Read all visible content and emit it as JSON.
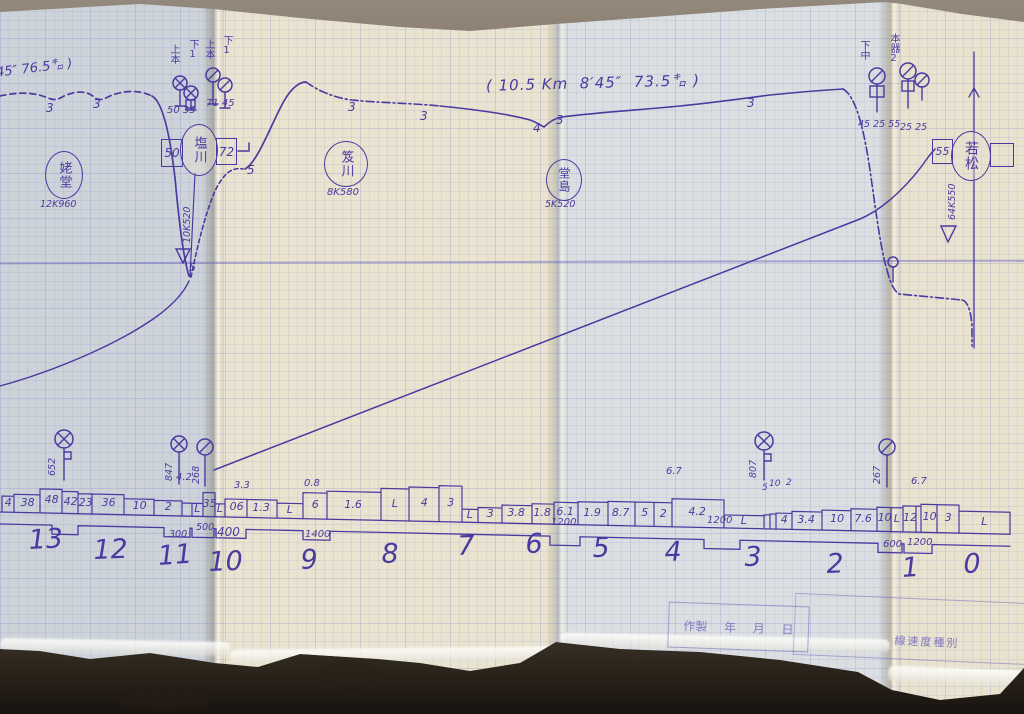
{
  "ink_color": "#4a3aa0",
  "annotations": {
    "main": "( 10.5 Km  8′45″  73.5㌔ )",
    "left_partial": "45″ 76.5㌔ )"
  },
  "stations": {
    "ubado": {
      "name": "姥堂",
      "km": "12K960"
    },
    "shiokawa": {
      "name": "塩川",
      "km": "10K520",
      "left_box": "50",
      "right_box": "72"
    },
    "oikawa": {
      "name": "笈川",
      "km": "8K580"
    },
    "dojima": {
      "name": "堂島",
      "km": "5K520"
    },
    "wakamatsu": {
      "name": "若松",
      "km": "64K550",
      "left_box": "55",
      "right_box": ""
    }
  },
  "stamp": {
    "made": "作製",
    "year": "年",
    "month": "月",
    "day": "日",
    "speed_class": "線速度種別"
  },
  "chart_data": {
    "type": "line",
    "title": "手書き運転曲線図（会津若松方面）",
    "run_annotation": {
      "distance_km": 10.5,
      "time": "8'45\"",
      "speed": "73.5 km/h"
    },
    "km_posts": [
      "13",
      "12",
      "11",
      "10",
      "9",
      "8",
      "7",
      "6",
      "5",
      "4",
      "3",
      "2",
      "1",
      "0"
    ],
    "speed_curve_marks": [
      "3",
      "3",
      "5",
      "3",
      "3",
      "4",
      "3",
      "3",
      "5"
    ],
    "gradient_profile_values": [
      "4",
      "38",
      "48",
      "42",
      "23",
      "36",
      "10",
      "2",
      "L",
      "35",
      "L",
      "06",
      "1.3",
      "L",
      "6",
      "1.6",
      "L",
      "4",
      "3",
      "L",
      "3",
      "3.8",
      "1.8",
      "6.1",
      "1.9",
      "8.7",
      "5",
      "2",
      "4.2",
      "L",
      "4",
      "3.4",
      "10",
      "7.6",
      "10",
      "L",
      "12",
      "10",
      "3",
      "L"
    ],
    "gradient_above_labels": [
      "4.2",
      "3.3",
      "0.8",
      "6.7",
      "5",
      "10",
      "2",
      "6.7"
    ],
    "curve_radius_restrictions": [
      "300",
      "500",
      "400",
      "1400",
      "1200",
      "1200",
      "600",
      "1200"
    ],
    "signal_numbers": [
      "50 35",
      "71 45",
      "45 25 55",
      "25 25",
      "652",
      "847",
      "268",
      "807",
      "267"
    ],
    "track_labels": [
      "上本",
      "下1",
      "上本",
      "下1",
      "下中",
      "本器2"
    ]
  },
  "texts": [
    {
      "t": "3",
      "x": 46,
      "y": 102,
      "s": 12
    },
    {
      "t": "3",
      "x": 93,
      "y": 98,
      "s": 12
    },
    {
      "t": "5",
      "x": 247,
      "y": 164,
      "s": 12
    },
    {
      "t": "3",
      "x": 348,
      "y": 101,
      "s": 12
    },
    {
      "t": "3",
      "x": 420,
      "y": 110,
      "s": 12
    },
    {
      "t": "4",
      "x": 533,
      "y": 122,
      "s": 12
    },
    {
      "t": "3",
      "x": 556,
      "y": 114,
      "s": 12
    },
    {
      "t": "3",
      "x": 747,
      "y": 97,
      "s": 12
    },
    {
      "t": "5",
      "x": 189,
      "y": 262,
      "s": 11
    },
    {
      "t": "50 35",
      "x": 167,
      "y": 106,
      "s": 10
    },
    {
      "t": "71 45",
      "x": 206,
      "y": 99,
      "s": 10
    },
    {
      "t": "45 25 55",
      "x": 858,
      "y": 120,
      "s": 9.5
    },
    {
      "t": "25 25",
      "x": 900,
      "y": 123,
      "s": 9.5
    },
    {
      "t": "上本",
      "x": 168,
      "y": 44,
      "s": 10,
      "v": 1
    },
    {
      "t": "下1",
      "x": 187,
      "y": 39,
      "s": 10,
      "v": 1
    },
    {
      "t": "上本",
      "x": 203,
      "y": 39,
      "s": 10,
      "v": 1
    },
    {
      "t": "下1",
      "x": 221,
      "y": 35,
      "s": 10,
      "v": 1
    },
    {
      "t": "下中",
      "x": 858,
      "y": 40,
      "s": 10,
      "v": 1
    },
    {
      "t": "本器2",
      "x": 888,
      "y": 33,
      "s": 10,
      "v": 1
    },
    {
      "t": "10K520",
      "x": 183,
      "y": 243,
      "s": 9.5,
      "r": -90
    },
    {
      "t": "64K550",
      "x": 948,
      "y": 220,
      "s": 9.5,
      "r": -90
    },
    {
      "t": "652",
      "x": 48,
      "y": 476,
      "s": 9.5,
      "r": -90
    },
    {
      "t": "847",
      "x": 165,
      "y": 481,
      "s": 9.5,
      "r": -90
    },
    {
      "t": "268",
      "x": 192,
      "y": 484,
      "s": 9.5,
      "r": -90
    },
    {
      "t": "807",
      "x": 749,
      "y": 478,
      "s": 9.5,
      "r": -90
    },
    {
      "t": "267",
      "x": 873,
      "y": 484,
      "s": 9.5,
      "r": -90
    },
    {
      "t": "4.2",
      "x": 176,
      "y": 473,
      "s": 10
    },
    {
      "t": "3.3",
      "x": 234,
      "y": 481,
      "s": 10
    },
    {
      "t": "0.8",
      "x": 304,
      "y": 479,
      "s": 10
    },
    {
      "t": "6.7",
      "x": 666,
      "y": 467,
      "s": 10
    },
    {
      "t": "5",
      "x": 762,
      "y": 484,
      "s": 9
    },
    {
      "t": "10",
      "x": 769,
      "y": 480,
      "s": 9
    },
    {
      "t": "2",
      "x": 786,
      "y": 479,
      "s": 9
    },
    {
      "t": "6.7",
      "x": 911,
      "y": 477,
      "s": 10
    },
    {
      "t": "300",
      "x": 169,
      "y": 530,
      "s": 9.5
    },
    {
      "t": "500",
      "x": 196,
      "y": 523,
      "s": 9.5
    },
    {
      "t": "400",
      "x": 217,
      "y": 526,
      "s": 12
    },
    {
      "t": "1400",
      "x": 305,
      "y": 530,
      "s": 10
    },
    {
      "t": "1200",
      "x": 551,
      "y": 518,
      "s": 10
    },
    {
      "t": "1200",
      "x": 707,
      "y": 516,
      "s": 10
    },
    {
      "t": "600",
      "x": 883,
      "y": 540,
      "s": 10
    },
    {
      "t": "1200",
      "x": 907,
      "y": 538,
      "s": 10
    },
    {
      "t": "13",
      "x": 28,
      "y": 527,
      "s": 27,
      "r": -3
    },
    {
      "t": "12",
      "x": 93,
      "y": 537,
      "s": 27,
      "r": -2
    },
    {
      "t": "11",
      "x": 157,
      "y": 543,
      "s": 27,
      "r": -4
    },
    {
      "t": "10",
      "x": 208,
      "y": 549,
      "s": 27,
      "r": -2
    },
    {
      "t": "9",
      "x": 300,
      "y": 547,
      "s": 27,
      "r": -3
    },
    {
      "t": "8",
      "x": 381,
      "y": 541,
      "s": 27,
      "r": -2
    },
    {
      "t": "7",
      "x": 457,
      "y": 533,
      "s": 27,
      "r": -2
    },
    {
      "t": "6",
      "x": 525,
      "y": 531,
      "s": 27,
      "r": -2
    },
    {
      "t": "5",
      "x": 592,
      "y": 535,
      "s": 27,
      "r": -2
    },
    {
      "t": "4",
      "x": 664,
      "y": 539,
      "s": 27,
      "r": -2
    },
    {
      "t": "3",
      "x": 744,
      "y": 544,
      "s": 27,
      "r": -2
    },
    {
      "t": "2",
      "x": 826,
      "y": 551,
      "s": 27,
      "r": -2
    },
    {
      "t": "1",
      "x": 901,
      "y": 555,
      "s": 27,
      "r": -4
    },
    {
      "t": "0",
      "x": 963,
      "y": 551,
      "s": 27,
      "r": -2
    }
  ],
  "profile_cells": [
    [
      2,
      12,
      "4",
      16
    ],
    [
      14,
      26,
      "38",
      18
    ],
    [
      40,
      22,
      "48",
      24
    ],
    [
      62,
      16,
      "42",
      22
    ],
    [
      78,
      14,
      "23",
      20
    ],
    [
      92,
      32,
      "36",
      20
    ],
    [
      124,
      30,
      "10",
      16
    ],
    [
      154,
      28,
      "2",
      15
    ],
    [
      182,
      10,
      "",
      13
    ],
    [
      192,
      11,
      "L",
      13
    ],
    [
      203,
      12,
      "35",
      24
    ],
    [
      215,
      10,
      "L",
      13
    ],
    [
      225,
      22,
      "06",
      18
    ],
    [
      247,
      30,
      "1.3",
      18
    ],
    [
      277,
      26,
      "L",
      15
    ],
    [
      303,
      24,
      "6",
      26
    ],
    [
      327,
      54,
      "1.6",
      28
    ],
    [
      381,
      28,
      "L",
      32
    ],
    [
      409,
      30,
      "4",
      34
    ],
    [
      439,
      23,
      "3",
      36
    ],
    [
      462,
      16,
      "L",
      13
    ],
    [
      478,
      24,
      "3",
      15
    ],
    [
      502,
      30,
      "3.8",
      18
    ],
    [
      532,
      22,
      "1.8",
      20
    ],
    [
      554,
      24,
      "6.1",
      22
    ],
    [
      578,
      30,
      "1.9",
      23
    ],
    [
      608,
      27,
      "8.7",
      24
    ],
    [
      635,
      19,
      "5",
      24
    ],
    [
      654,
      18,
      "2",
      24
    ],
    [
      672,
      52,
      "4.2",
      28
    ],
    [
      724,
      40,
      "L",
      13
    ],
    [
      764,
      6,
      "",
      14
    ],
    [
      770,
      6,
      "",
      15
    ],
    [
      776,
      16,
      "4",
      16
    ],
    [
      792,
      30,
      "3.4",
      18
    ],
    [
      822,
      29,
      "10",
      20
    ],
    [
      851,
      26,
      "7.6",
      22
    ],
    [
      877,
      14,
      "10",
      24
    ],
    [
      891,
      12,
      "L",
      24
    ],
    [
      903,
      13,
      "12",
      26
    ],
    [
      916,
      5,
      "",
      26
    ],
    [
      921,
      16,
      "10",
      28
    ],
    [
      937,
      22,
      "3",
      28
    ],
    [
      959,
      51,
      "L",
      22
    ]
  ],
  "profile_notches": [
    [
      52,
      78
    ],
    [
      164,
      190
    ],
    [
      192,
      214
    ],
    [
      216,
      246
    ],
    [
      303,
      330
    ],
    [
      550,
      580
    ],
    [
      704,
      740
    ],
    [
      878,
      902
    ],
    [
      904,
      932
    ]
  ],
  "signals": [
    {
      "k": "cx",
      "x": 180,
      "y": 83,
      "r": 7,
      "p": 106,
      "foot": 1
    },
    {
      "k": "cx",
      "x": 191,
      "y": 93,
      "r": 7,
      "p": 110,
      "foot": 1,
      "box": [
        186,
        100,
        9,
        8
      ]
    },
    {
      "k": "cs",
      "x": 213,
      "y": 75,
      "r": 7,
      "p": 104,
      "foot": 1
    },
    {
      "k": "cs",
      "x": 225,
      "y": 85,
      "r": 7,
      "p": 108,
      "foot": 1
    },
    {
      "k": "cs",
      "x": 877,
      "y": 76,
      "r": 8,
      "p": 112,
      "box": [
        870,
        86,
        14,
        11
      ]
    },
    {
      "k": "cs",
      "x": 908,
      "y": 71,
      "r": 8,
      "p": 108,
      "box": [
        902,
        81,
        12,
        10
      ]
    },
    {
      "k": "cs",
      "x": 922,
      "y": 80,
      "r": 7,
      "p": 100
    },
    {
      "k": "cx",
      "x": 64,
      "y": 439,
      "r": 9,
      "p": 480,
      "flag": 1
    },
    {
      "k": "cx",
      "x": 179,
      "y": 444,
      "r": 8,
      "p": 484
    },
    {
      "k": "cs",
      "x": 205,
      "y": 447,
      "r": 8,
      "p": 486
    },
    {
      "k": "cx",
      "x": 764,
      "y": 441,
      "r": 9,
      "p": 480,
      "flag": 1
    },
    {
      "k": "cs",
      "x": 887,
      "y": 447,
      "r": 8,
      "p": 487
    },
    {
      "k": "c",
      "x": 893,
      "y": 262,
      "r": 5,
      "p": 282
    }
  ]
}
